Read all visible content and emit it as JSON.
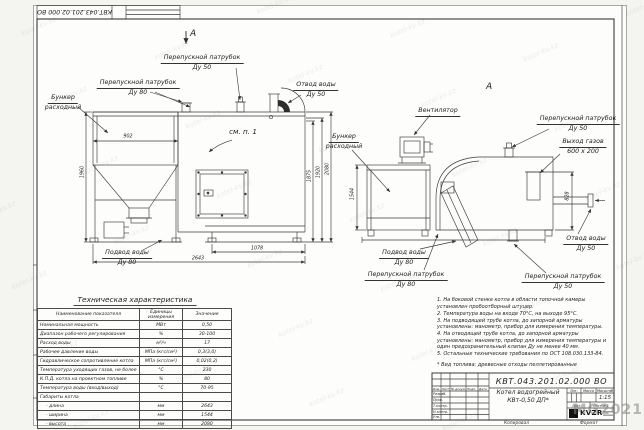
{
  "doc": {
    "number": "КВТ.043.201.02.000 ВО",
    "name_line1": "Котел водогрейный",
    "name_line2": "КВт-0,50 ДП*"
  },
  "markers": {
    "section_a": "А",
    "see_item": "см. п. 1"
  },
  "left_view": {
    "labels": {
      "hopper_l1": "Бункер",
      "hopper_l2": "расходный",
      "bypass80_l1": "Перепускной патрубок",
      "bypass80_l2": "Ду 80",
      "bypass50_l1": "Перепускной патрубок",
      "bypass50_l2": "Ду 50",
      "water_out_l1": "Отвод воды",
      "water_out_l2": "Ду 50",
      "water_in_l1": "Подвод воды",
      "water_in_l2": "Ду 80"
    },
    "dims": {
      "hopper_width": "902",
      "h_left": "1960",
      "h1": "1875",
      "h2": "1920",
      "h3": "2080",
      "len_mid": "1078",
      "len_total": "2643"
    }
  },
  "right_view": {
    "labels": {
      "fan": "Вентилятор",
      "hopper_l1": "Бункер",
      "hopper_l2": "расходный",
      "bypass50_top_l1": "Перепускной патрубок",
      "bypass50_top_l2": "Ду 50",
      "gas_out_l1": "Выход газов",
      "gas_out_l2": "600 x 200",
      "water_out_l1": "Отвод воды",
      "water_out_l2": "Ду 50",
      "water_in_l1": "Подвод воды",
      "water_in_l2": "Ду 80",
      "bypass80_l1": "Перепускной патрубок",
      "bypass80_l2": "Ду 80",
      "bypass50_bot_l1": "Перепускной патрубок",
      "bypass50_bot_l2": "Ду 50"
    },
    "dims": {
      "width": "1544",
      "gas_h": "828"
    }
  },
  "spec_table": {
    "title": "Техническая характеристика",
    "headers": [
      "Наименование показателя",
      "Единицы измерения",
      "Значение"
    ],
    "rows": [
      [
        "Номинальная мощность",
        "МВт",
        "0,50"
      ],
      [
        "Диапазон рабочего регулирования",
        "%",
        "30-100"
      ],
      [
        "Расход воды",
        "м³/ч",
        "17"
      ],
      [
        "Рабочее давление воды",
        "МПа (кгс/см²)",
        "0,3(3,0)"
      ],
      [
        "Гидравлическое сопротивление котла",
        "МПа (кгс/см²)",
        "0,02(0,2)"
      ],
      [
        "Температура уходящих газов, не более",
        "°С",
        "230"
      ],
      [
        "К.П.Д. котла на проектном топливе",
        "%",
        "80"
      ],
      [
        "Температура воды (вход/выход)",
        "°С",
        "70-95"
      ],
      [
        "Габариты котла",
        "",
        ""
      ],
      [
        "    - длина",
        "мм",
        "2643"
      ],
      [
        "    - ширина",
        "мм",
        "1544"
      ],
      [
        "    - высота",
        "мм",
        "2080"
      ]
    ]
  },
  "notes": {
    "items": [
      "1.  На боковой стенке котла в области топочной камеры установлен пробоотборный штуцер.",
      "2.  Температура воды на входе 70°С, на выходе 95°С.",
      "3.  На подводящей трубе котла, до запорной арматуры установлены: манометр, прибор для измерения температуры.",
      "4.  На отводящей трубе котла, до запорной арматуры установлены: манометр, прибор для измерения температуры и один предохранительный клапан Ду не менее 40 мм.",
      "5.  Остальные технические требования по ОСТ 108.030.133-84."
    ],
    "fuel": "*  Вид топлива: древесные отходы пеллетированные"
  },
  "title_block": {
    "izm": "Изм.",
    "list_col": "Лист",
    "ndoc": "№ докум.",
    "podp": "Подп.",
    "data_col": "Дата",
    "razrab": "Разраб.",
    "prov": "Пров.",
    "tkontr": "Т.контр.",
    "nkontr": "Н.контр.",
    "utv": "Утв.",
    "lit": "Лит.",
    "massa": "Масса",
    "masshtab": "Масштаб",
    "scale": "1:15",
    "list": "Лист",
    "listov": "Листов 1",
    "logo": "KVZR",
    "kopiroval": "Копировал",
    "format": "Формат"
  },
  "watermark": {
    "tile": "kotel-kv.kz",
    "big": "MG2021"
  }
}
